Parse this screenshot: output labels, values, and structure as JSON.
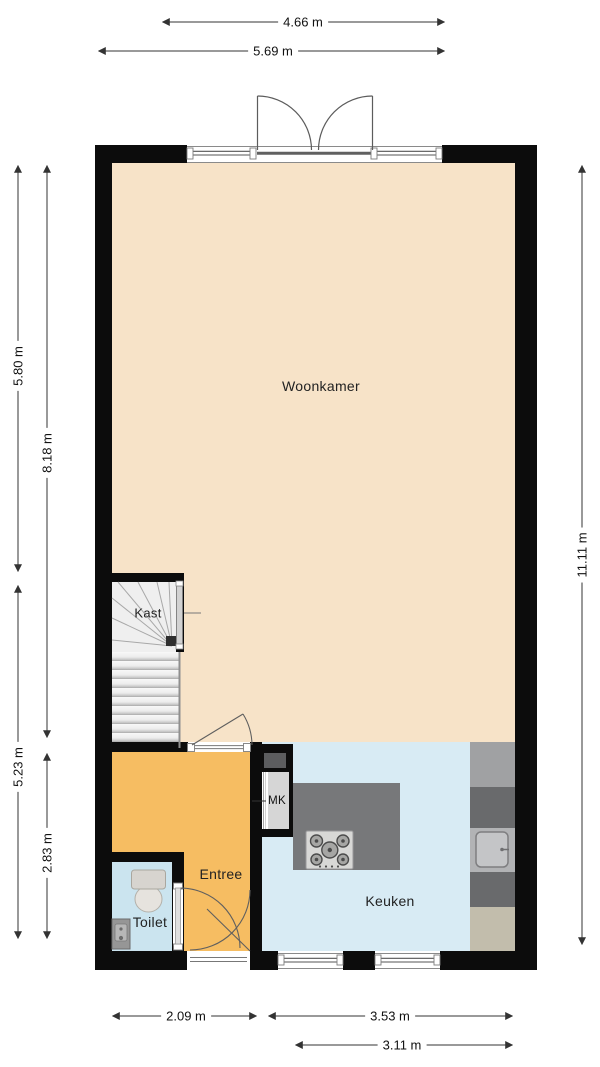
{
  "floorplan": {
    "rooms": {
      "woonkamer": {
        "label": "Woonkamer"
      },
      "kast": {
        "label": "Kast"
      },
      "entree": {
        "label": "Entree"
      },
      "toilet": {
        "label": "Toilet"
      },
      "keuken": {
        "label": "Keuken"
      },
      "meterkast": {
        "label": "MK"
      }
    },
    "dimensions": {
      "top_inner": "4.66 m",
      "top_outer": "5.69 m",
      "left_upper": "5.80 m",
      "left_full": "8.18 m",
      "left_lower": "5.23 m",
      "left_bottom": "2.83 m",
      "right_full": "11.11 m",
      "bottom_entree": "2.09 m",
      "bottom_keuken_outer": "3.53 m",
      "bottom_keuken_inner": "3.11 m"
    },
    "fixtures": [
      "stairs",
      "toilet",
      "hand-basin",
      "gas-hob",
      "kitchen-sink",
      "double-garden-doors",
      "front-door"
    ]
  },
  "colors": {
    "wall": "#0c0c0c",
    "floor-woonkamer": "#f7e3c8",
    "floor-entree": "#f6bd62",
    "floor-keuken": "#d8ebf4",
    "floor-toilet": "#cbe4ef",
    "counter-grey": "#77787a",
    "counter-dark": "#696a6c",
    "counter-light": "#a0a1a3",
    "counter-tan": "#c2bdac",
    "dimension-line": "#333333"
  }
}
